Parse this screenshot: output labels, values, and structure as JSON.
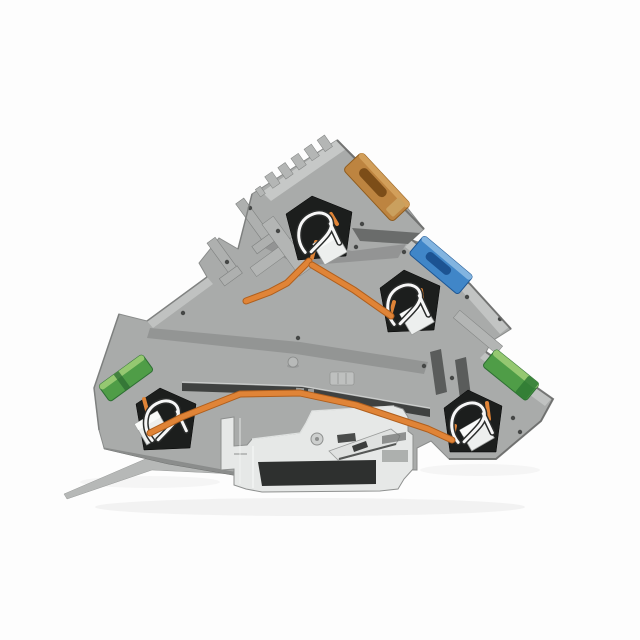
{
  "scene": {
    "type": "product-photo",
    "subject": "Gray multi-level DIN-rail terminal block with push-in spring clamps, shown in cutaway on white background",
    "background": "#fdfdfd"
  },
  "colors": {
    "body_gray": "#a9abaa",
    "body_gray_light": "#c6c8c7",
    "body_gray_dark": "#7d7f7e",
    "cavity_dark": "#1c1e1d",
    "busbar_orange": "#e08437",
    "busbar_orange_dark": "#b05f1d",
    "actuator_amber": "#bd8440",
    "actuator_blue": "#4086c8",
    "terminal_green": "#4f9d47",
    "terminal_green_light": "#9ccd75",
    "metal_silver": "#e6e8e7",
    "spring_white": "#f7f7f7",
    "slot_dark": "#2e302f"
  },
  "parts": {
    "housing": "gray insulating housing with three stepped levels",
    "top_actuator": "amber operating slot on top level",
    "middle_actuator": "blue operating slot on middle level",
    "left_terminal": "green conductor entry, lower left",
    "right_terminal": "green conductor entry, lower right",
    "spring_clamps": "four stainless clamping springs in dark cavities",
    "busbar": "copper bus bar linking the clamp points",
    "din_clip": "steel DIN-rail mounting foot with latch and release blade"
  }
}
